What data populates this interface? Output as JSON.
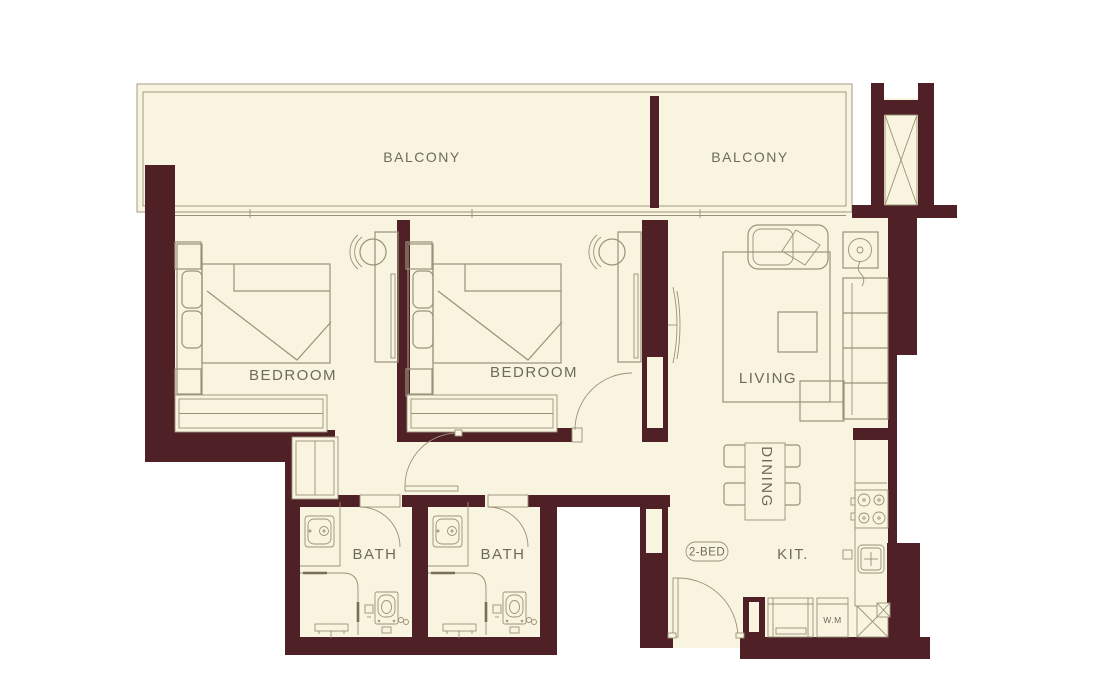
{
  "plan": {
    "unit_badge": "2-BED"
  },
  "labels": {
    "balcony_left": "BALCONY",
    "balcony_right": "BALCONY",
    "bedroom_left": "BEDROOM",
    "bedroom_right": "BEDROOM",
    "living": "LIVING",
    "dining": "DINING",
    "kitchen": "KIT.",
    "bath_left": "BATH",
    "bath_right": "BATH",
    "washing_machine": "W.M"
  },
  "colors": {
    "wall": "#4f2127",
    "floor": "#f8f4e0",
    "line": "#9c9178",
    "text": "#6e6b5c",
    "background": "#ffffff"
  }
}
